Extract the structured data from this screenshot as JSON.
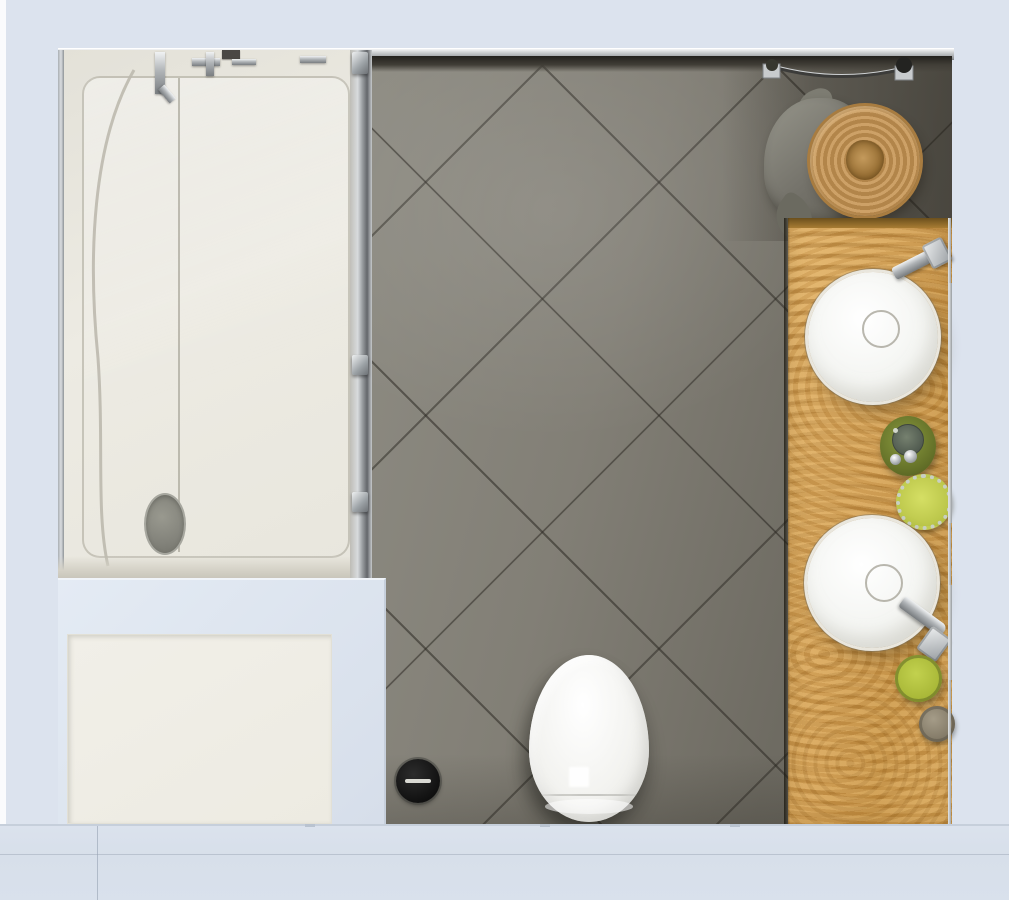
{
  "scene": {
    "description": "Top-down 3D render of a bathroom interior",
    "view": "top-down"
  },
  "colors": {
    "bg": "#dce3ee",
    "bg2": "#d7dfea",
    "tile": "#8e8c83",
    "tileMid": "#6e6b62",
    "tileDark": "#57534a",
    "grout": "#2c2923",
    "tub": "#eae8e0",
    "tubDrain": "#83837b",
    "mat": "#edebe2",
    "blueZone": "#d6deea",
    "wood": "#d4a157",
    "woodDark": "#6b4f1d",
    "sink": "#f4f5f2",
    "toilet": "#f3f3f0",
    "chrome": "#c9ccce",
    "basket": "#c1975c",
    "basketRing": "#b2854a",
    "towel": "#74726a",
    "olive": "#67742a",
    "lime": "#bcc74b",
    "cupGreen": "#a9b838",
    "drain": "#101010"
  },
  "fixtures": [
    {
      "id": "shower-bathtub",
      "label": "Shower bathtub enclosure"
    },
    {
      "id": "glass-door",
      "label": "Shower glass door frame"
    },
    {
      "id": "bath-mat",
      "label": "Bath mat"
    },
    {
      "id": "tile-floor",
      "label": "Gray diagonal tile floor"
    },
    {
      "id": "toilet",
      "label": "Toilet"
    },
    {
      "id": "floor-drain",
      "label": "Floor drain"
    },
    {
      "id": "towel-bar",
      "label": "Towel bar"
    },
    {
      "id": "towel",
      "label": "Gray towel"
    },
    {
      "id": "wicker-basket",
      "label": "Wicker basket"
    },
    {
      "id": "vanity-counter",
      "label": "Wooden vanity counter"
    },
    {
      "id": "vessel-sink-top",
      "label": "Round vessel sink (top)"
    },
    {
      "id": "vessel-sink-bottom",
      "label": "Round vessel sink (bottom)"
    },
    {
      "id": "faucet-top",
      "label": "Chrome faucet (top sink)"
    },
    {
      "id": "faucet-bottom",
      "label": "Chrome faucet (bottom sink)"
    },
    {
      "id": "soap-dish",
      "label": "Olive soap dish with pebbles"
    },
    {
      "id": "green-jar",
      "label": "Green jar with mosaic rim"
    },
    {
      "id": "green-cup",
      "label": "Green cup"
    },
    {
      "id": "small-cup",
      "label": "Small gray cup"
    }
  ]
}
